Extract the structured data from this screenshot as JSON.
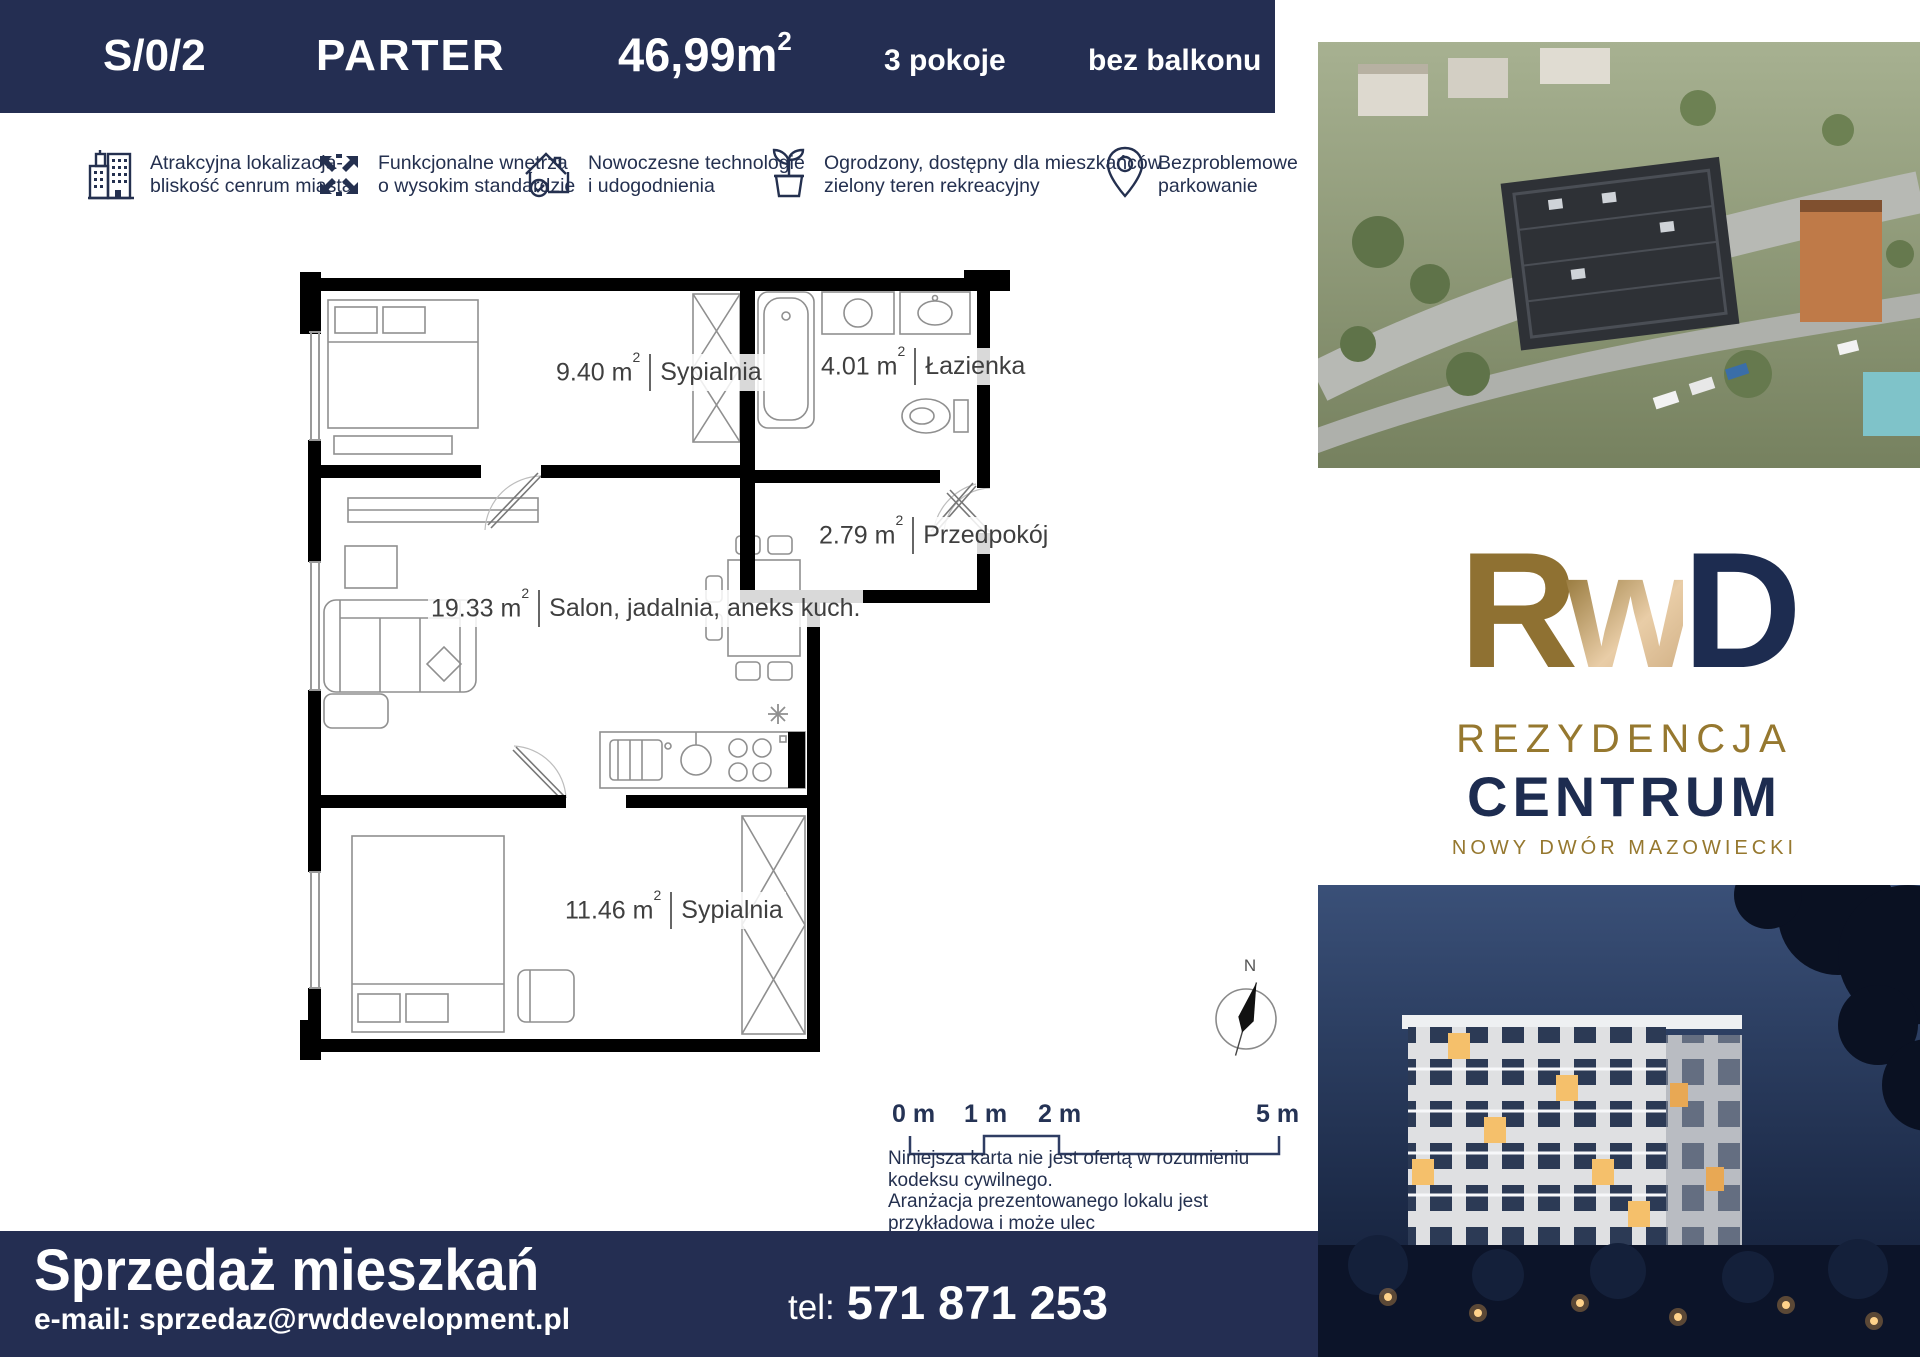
{
  "header": {
    "unit": "S/0/2",
    "floor": "PARTER",
    "area": "46,99m",
    "area_sup": "2",
    "rooms": "3 pokoje",
    "balcony": "bez balkonu"
  },
  "features": [
    {
      "icon": "building-icon",
      "line1": "Atrakcyjna lokalizacja-",
      "line2": "bliskość cenrum miasta"
    },
    {
      "icon": "expand-arrows-icon",
      "line1": "Funkcjonalne wnętrza",
      "line2": "o wysokim standardzie"
    },
    {
      "icon": "house-check-icon",
      "line1": "Nowoczesne technologie",
      "line2": "i udogodnienia"
    },
    {
      "icon": "plant-icon",
      "line1": "Ogrodzony, dostępny dla mieszkańców",
      "line2": "zielony teren rekreacyjny"
    },
    {
      "icon": "location-pin-icon",
      "line1": "Bezproblemowe",
      "line2": "parkowanie"
    }
  ],
  "plan": {
    "area_sup": "2",
    "rooms": [
      {
        "area": "9.40 m",
        "name": "Sypialnia"
      },
      {
        "area": "4.01 m",
        "name": "Łazienka"
      },
      {
        "area": "2.79 m",
        "name": "Przedpokój"
      },
      {
        "area": "19.33 m",
        "name": "Salon, jadalnia, aneks kuch."
      },
      {
        "area": "11.46 m",
        "name": "Sypialnia"
      }
    ]
  },
  "scalebar": {
    "labels": [
      "0 m",
      "1 m",
      "2 m",
      "5 m"
    ]
  },
  "disclaimer": {
    "lines": [
      "Niniejsza karta nie jest ofertą w rozumieniu kodeksu cywilnego.",
      "Aranżacja prezentowanego lokalu jest przykładowa i może ulec",
      "zmianie. Podziałka podana z tolerancją 5%."
    ]
  },
  "compass": {
    "north": "N"
  },
  "logo": {
    "letter_r": "R",
    "letter_w": "w",
    "letter_d": "D",
    "line1": "REZYDENCJA",
    "line2": "CENTRUM",
    "line3": "NOWY DWÓR MAZOWIECKI"
  },
  "footer": {
    "title": "Sprzedaż mieszkań",
    "email_label": "e-mail:",
    "email": "sprzedaz@rwddevelopment.pl",
    "phone_label": "tel:",
    "phone": "571 871 253"
  },
  "colors": {
    "navy": "#242e52",
    "gold": "#96782f",
    "logo_navy": "#1d2c50"
  }
}
